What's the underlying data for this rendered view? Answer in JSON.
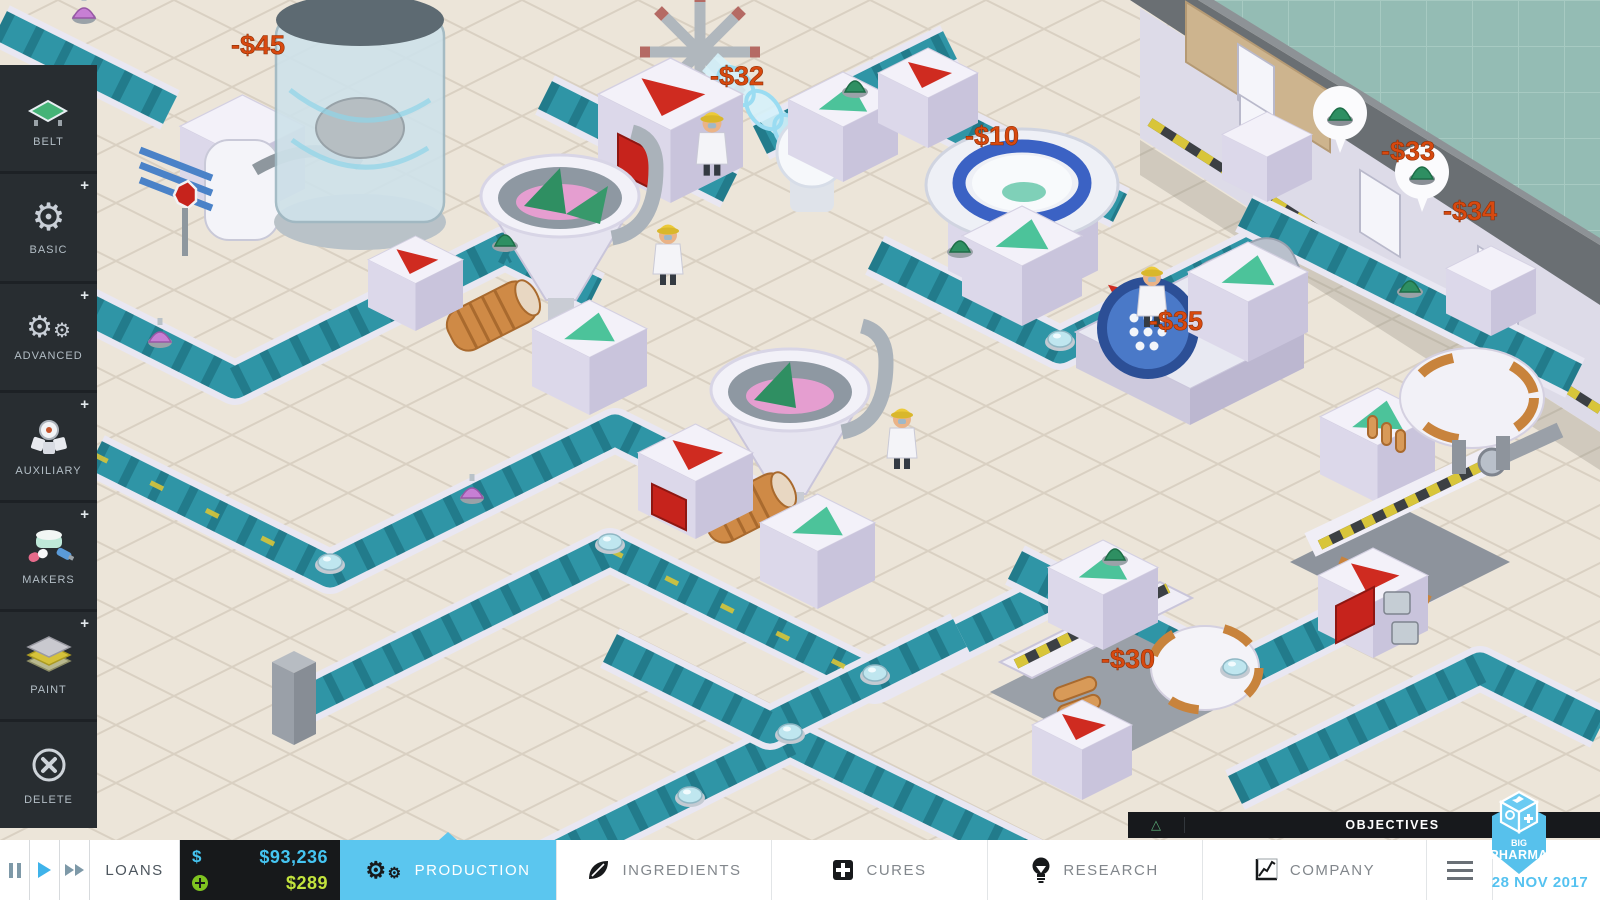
{
  "app": {
    "name_line1": "BIG",
    "name_line2": "PHARMA",
    "date": "28 NOV 2017"
  },
  "sidebar": {
    "plus_badge": "+",
    "items": [
      {
        "label": "BELT",
        "icon": "belt-icon",
        "has_plus": false
      },
      {
        "label": "BASIC",
        "icon": "gear-icon",
        "has_plus": true
      },
      {
        "label": "ADVANCED",
        "icon": "double-gear-icon",
        "has_plus": true
      },
      {
        "label": "AUXILIARY",
        "icon": "robot-icon",
        "has_plus": true
      },
      {
        "label": "MAKERS",
        "icon": "pill-maker-icon",
        "has_plus": true
      },
      {
        "label": "PAINT",
        "icon": "paint-layers-icon",
        "has_plus": true
      },
      {
        "label": "DELETE",
        "icon": "delete-icon",
        "has_plus": false
      }
    ]
  },
  "bottom_bar": {
    "loans_label": "LOANS",
    "money_symbol": "$",
    "balance": "$93,236",
    "income": "$289",
    "tabs": [
      {
        "label": "PRODUCTION",
        "active": true
      },
      {
        "label": "INGREDIENTS",
        "active": false
      },
      {
        "label": "CURES",
        "active": false
      },
      {
        "label": "RESEARCH",
        "active": false
      },
      {
        "label": "COMPANY",
        "active": false
      }
    ]
  },
  "objectives": {
    "title": "OBJECTIVES",
    "marker": "△"
  },
  "scene": {
    "cost_labels": [
      {
        "text": "-$45"
      },
      {
        "text": "-$32"
      },
      {
        "text": "-$10"
      },
      {
        "text": "-$33"
      },
      {
        "text": "-$34"
      },
      {
        "text": "-$35"
      },
      {
        "text": "-$30"
      }
    ]
  },
  "colors": {
    "accent_blue": "#5bc6ef",
    "money_blue": "#45c5f2",
    "income_green": "#c3e43d",
    "cost_red": "#d8490f",
    "belt_teal": "#2f95a6"
  }
}
